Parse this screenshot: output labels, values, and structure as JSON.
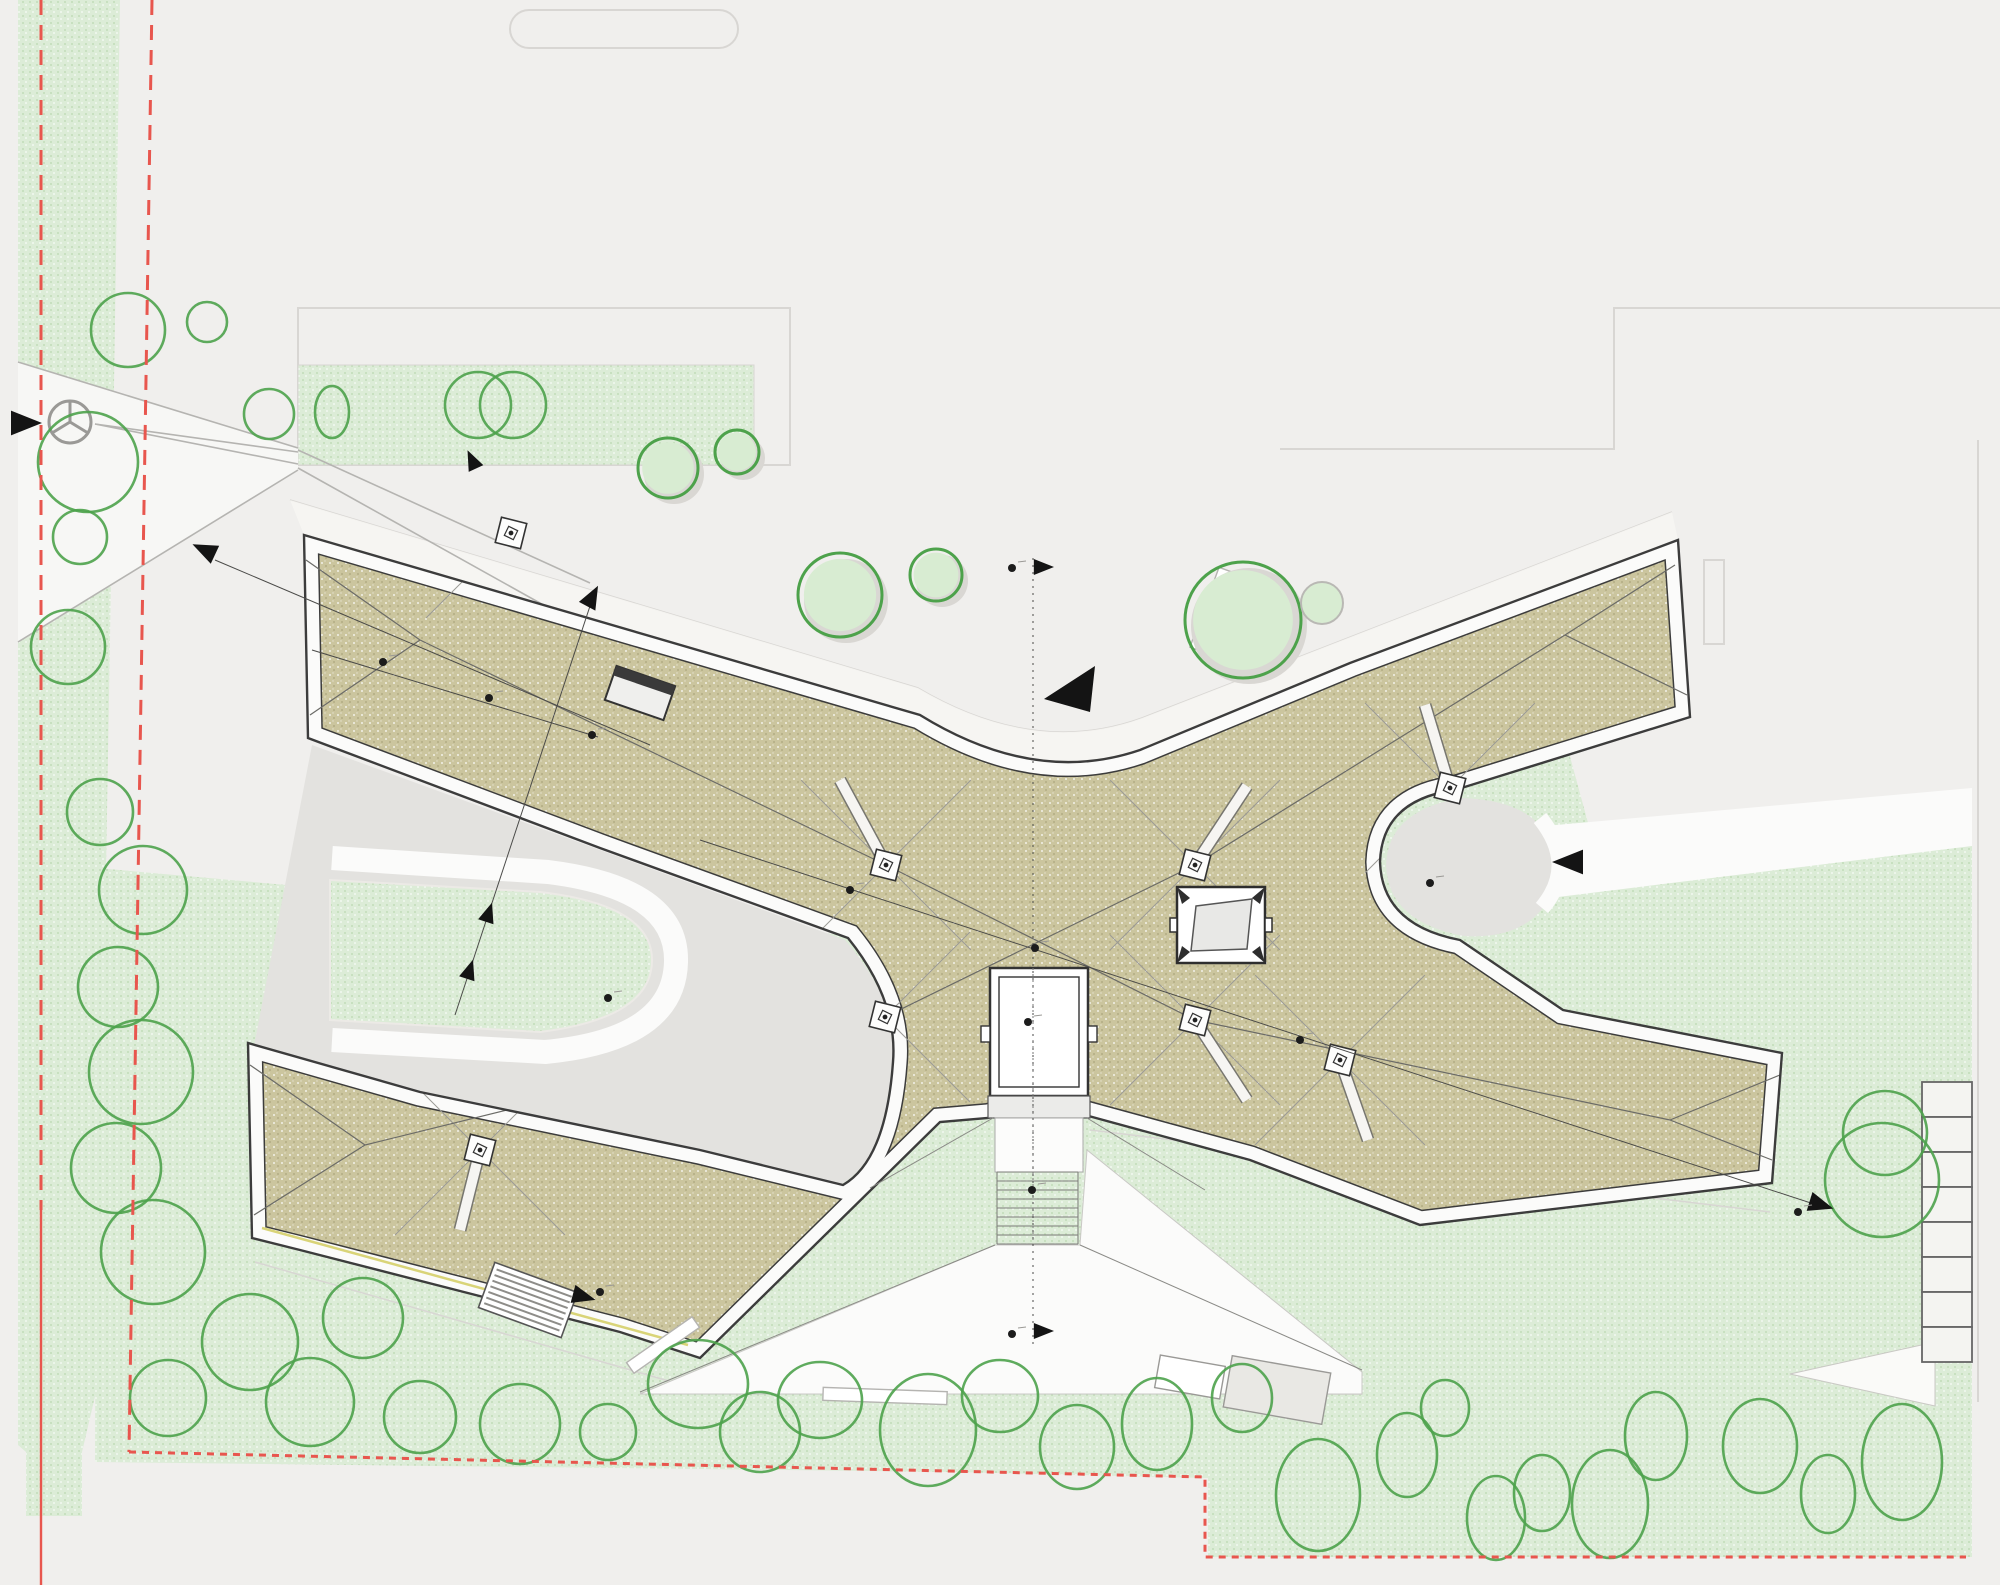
{
  "meta": {
    "title": "Site plan — X-shaped pavilion roof plan",
    "kind": "architectural-drawing",
    "scale_text": ""
  },
  "palette": {
    "bg": "#f0efed",
    "lawn": "#dcecd7",
    "lawnDot": "#c2dcb8",
    "roof": "#cbc59e",
    "roofDotDark": "#b3ac84",
    "paving": "#e3e2df",
    "plaza": "#fbfbfa",
    "white": "#ffffff",
    "lineDark": "#3c3c3c",
    "lineMid": "#8a8a8a",
    "lineLight": "#b5b4b1",
    "faint": "#d8d6d3",
    "red": "#e8564e",
    "tree": "#4da24b",
    "treeFill": "#d8ecd2",
    "shadow": "#d9d7d3",
    "black": "#141414",
    "yellowEdge": "#d9d478",
    "walk": "#f6f5f2"
  },
  "trees_outline": [
    [
      128,
      330,
      37,
      37
    ],
    [
      88,
      462,
      50,
      50
    ],
    [
      80,
      537,
      27,
      27
    ],
    [
      68,
      647,
      37,
      37
    ],
    [
      100,
      812,
      33,
      33
    ],
    [
      143,
      890,
      44,
      44
    ],
    [
      118,
      987,
      40,
      40
    ],
    [
      141,
      1072,
      52,
      52
    ],
    [
      116,
      1168,
      45,
      45
    ],
    [
      153,
      1252,
      52,
      52
    ],
    [
      250,
      1342,
      48,
      48
    ],
    [
      168,
      1398,
      38,
      38
    ],
    [
      310,
      1402,
      44,
      44
    ],
    [
      420,
      1417,
      36,
      36
    ],
    [
      207,
      322,
      20,
      20
    ],
    [
      269,
      414,
      25,
      25
    ],
    [
      332,
      412,
      17,
      26
    ],
    [
      478,
      405,
      33,
      33
    ],
    [
      513,
      405,
      33,
      33
    ],
    [
      363,
      1318,
      40,
      40
    ],
    [
      520,
      1424,
      40,
      40
    ],
    [
      608,
      1432,
      28,
      28
    ],
    [
      698,
      1384,
      50,
      44
    ],
    [
      760,
      1432,
      40,
      40
    ],
    [
      820,
      1400,
      42,
      38
    ],
    [
      928,
      1430,
      48,
      56
    ],
    [
      1000,
      1396,
      38,
      36
    ],
    [
      1077,
      1447,
      37,
      42
    ],
    [
      1157,
      1424,
      35,
      46
    ],
    [
      1242,
      1398,
      30,
      34
    ],
    [
      1318,
      1495,
      42,
      56
    ],
    [
      1407,
      1455,
      30,
      42
    ],
    [
      1445,
      1408,
      24,
      28
    ],
    [
      1496,
      1518,
      29,
      42
    ],
    [
      1542,
      1493,
      28,
      38
    ],
    [
      1610,
      1504,
      38,
      54
    ],
    [
      1656,
      1436,
      31,
      44
    ],
    [
      1760,
      1446,
      37,
      47
    ],
    [
      1828,
      1494,
      27,
      39
    ],
    [
      1902,
      1462,
      40,
      58
    ],
    [
      1885,
      1133,
      42,
      42
    ],
    [
      1882,
      1180,
      57,
      57
    ]
  ],
  "trees_filled": [
    [
      840,
      595,
      42
    ],
    [
      936,
      575,
      26
    ],
    [
      1243,
      620,
      58
    ],
    [
      668,
      468,
      30
    ],
    [
      737,
      452,
      22
    ]
  ],
  "bushes": [
    [
      1322,
      603,
      21
    ]
  ],
  "drains": [
    [
      511,
      533
    ],
    [
      886,
      865
    ],
    [
      1195,
      865
    ],
    [
      885,
      1017
    ],
    [
      1195,
      1020
    ],
    [
      1450,
      788
    ],
    [
      480,
      1150
    ],
    [
      1340,
      1060
    ]
  ],
  "straps": [
    [
      886,
      865,
      840,
      780
    ],
    [
      1195,
      865,
      1247,
      786
    ],
    [
      885,
      1017,
      840,
      1098
    ],
    [
      1195,
      1020,
      1247,
      1100
    ],
    [
      1450,
      788,
      1425,
      705
    ],
    [
      480,
      1150,
      460,
      1230
    ],
    [
      1340,
      1060,
      1368,
      1140
    ],
    [
      511,
      533,
      522,
      578
    ]
  ],
  "hip_lines": [
    [
      306,
      560,
      420,
      640
    ],
    [
      310,
      715,
      420,
      640
    ],
    [
      250,
      1065,
      365,
      1145
    ],
    [
      254,
      1215,
      365,
      1145
    ],
    [
      1675,
      565,
      1565,
      635
    ],
    [
      1687,
      695,
      1565,
      635
    ],
    [
      1780,
      1075,
      1670,
      1120
    ],
    [
      1772,
      1160,
      1670,
      1120
    ],
    [
      886,
      865,
      1195,
      1020
    ],
    [
      1195,
      865,
      885,
      1017
    ],
    [
      420,
      640,
      886,
      865
    ],
    [
      365,
      1145,
      885,
      1017
    ],
    [
      1565,
      635,
      1195,
      865
    ],
    [
      1670,
      1120,
      1195,
      1020
    ]
  ],
  "section_lines": [
    [
      215,
      560,
      650,
      745
    ],
    [
      312,
      650,
      598,
      737
    ],
    [
      592,
      600,
      455,
      1015
    ],
    [
      700,
      840,
      1820,
      1206
    ]
  ],
  "centerline": {
    "x": 1033,
    "y1": 558,
    "y2": 1345
  },
  "arrows": [
    {
      "x": 22,
      "y": 423,
      "r": 0,
      "s": 20
    },
    {
      "x": 207,
      "y": 551,
      "r": 205,
      "s": 16
    },
    {
      "x": 473,
      "y": 462,
      "r": 245,
      "s": 13
    },
    {
      "x": 591,
      "y": 599,
      "r": 298,
      "s": 15
    },
    {
      "x": 488,
      "y": 915,
      "r": 288,
      "s": 13
    },
    {
      "x": 469,
      "y": 972,
      "r": 288,
      "s": 13
    },
    {
      "x": 581,
      "y": 1296,
      "r": 15,
      "s": 15
    },
    {
      "x": 1572,
      "y": 862,
      "r": 180,
      "s": 20
    },
    {
      "x": 1818,
      "y": 1204,
      "r": 17,
      "s": 16
    },
    {
      "x": 1041,
      "y": 567,
      "r": 0,
      "s": 13
    },
    {
      "x": 1041,
      "y": 1331,
      "r": 0,
      "s": 13
    }
  ],
  "big_arrow": "1095,666 1044,699 1090,712",
  "dots": [
    [
      383,
      662
    ],
    [
      489,
      698
    ],
    [
      592,
      735
    ],
    [
      850,
      890
    ],
    [
      1300,
      1040
    ],
    [
      1035,
      948
    ],
    [
      1028,
      1022
    ],
    [
      1032,
      1190
    ],
    [
      608,
      998
    ],
    [
      1430,
      883
    ],
    [
      1012,
      568
    ],
    [
      1012,
      1334
    ],
    [
      600,
      1292
    ],
    [
      1798,
      1212
    ]
  ],
  "benches": [
    {
      "cx": 1212,
      "cy": 610,
      "w": 16,
      "h": 85,
      "rot": 20,
      "fill": "#ffffff",
      "stroke": "#b5b4b1"
    },
    {
      "cx": 663,
      "cy": 1345,
      "w": 80,
      "h": 13,
      "rot": -35,
      "fill": "#ffffff",
      "stroke": "#b5b4b1"
    },
    {
      "cx": 885,
      "cy": 1396,
      "w": 124,
      "h": 13,
      "rot": 2,
      "fill": "#ffffff",
      "stroke": "#b5b4b1"
    },
    {
      "cx": 1190,
      "cy": 1377,
      "w": 66,
      "h": 33,
      "rot": 10,
      "fill": "#ffffff",
      "stroke": "#9a9996"
    },
    {
      "cx": 1277,
      "cy": 1390,
      "w": 100,
      "h": 52,
      "rot": 10,
      "fill": "#e9e8e4",
      "stroke": "#9a9996"
    }
  ],
  "grate": {
    "cx": 528,
    "cy": 1300,
    "w": 88,
    "h": 48,
    "rot": 20,
    "hatch": 7
  },
  "roof_hatch": {
    "cx": 640,
    "cy": 693,
    "w": 62,
    "h": 36,
    "rot": 19
  },
  "parking": {
    "x": 1922,
    "y": 1082,
    "w": 50,
    "h": 35,
    "count": 8
  },
  "stairs": {
    "x": 997,
    "y": 1172,
    "w": 81,
    "step": 9,
    "count": 9
  }
}
